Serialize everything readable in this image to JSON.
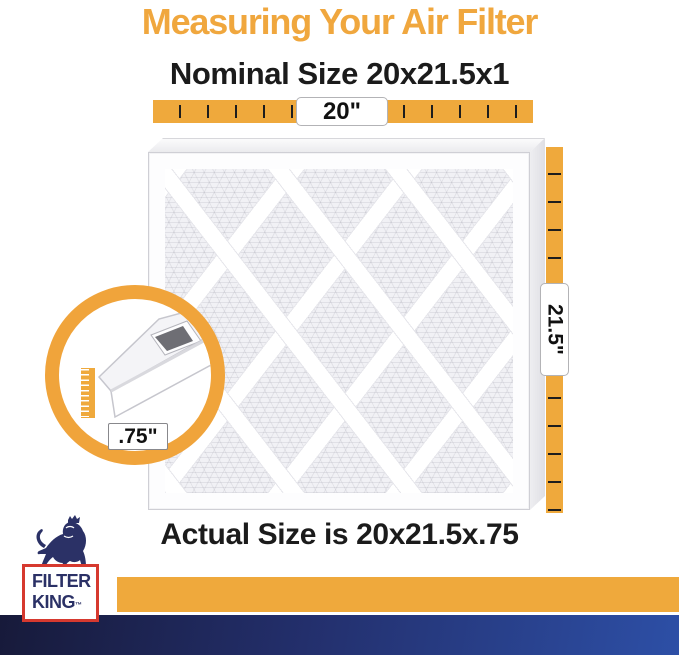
{
  "title": "Measuring Your Air Filter",
  "nominal_size_label": "Nominal Size 20x21.5x1",
  "actual_size_label": "Actual Size is 20x21.5x.75",
  "measurements": {
    "width": "20\"",
    "height": "21.5\"",
    "depth": ".75\""
  },
  "logo": {
    "brand_line1": "FILTER",
    "brand_line2": "KING",
    "trademark": "™",
    "icon": "lion-with-crown-icon"
  },
  "colors": {
    "accent_orange": "#EFA93C",
    "title_orange": "#F0A73E",
    "text_black": "#1B1B1B",
    "logo_navy": "#2B3166",
    "logo_red": "#D6392F",
    "footer_navy_dark": "#171A3A",
    "footer_navy_light": "#2D4FA6"
  }
}
